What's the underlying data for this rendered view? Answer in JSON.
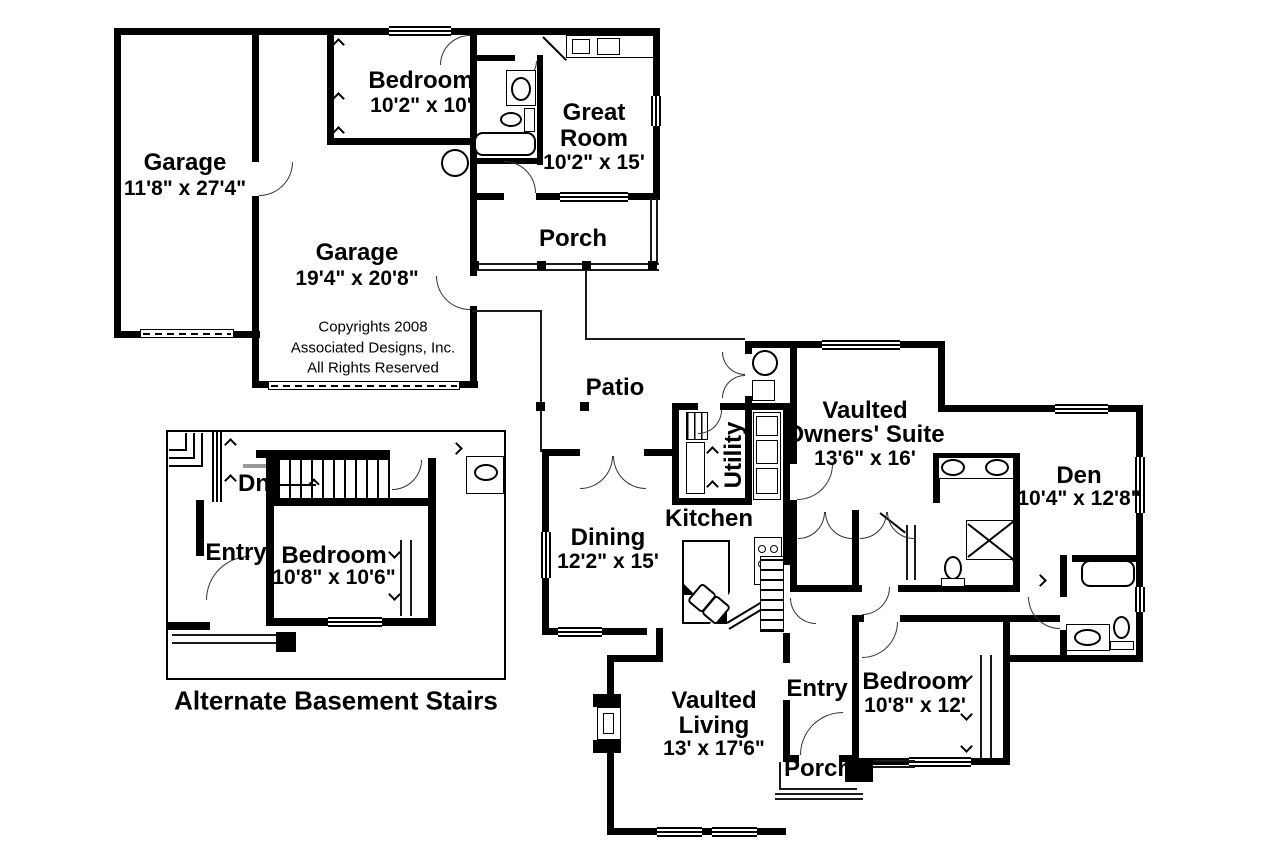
{
  "canvas": {
    "width": 1280,
    "height": 853,
    "background": "#ffffff"
  },
  "colors": {
    "wall": "#000000",
    "thin_line": "#1a1a1a",
    "arc_line": "#333333",
    "text": "#000000"
  },
  "copyright": {
    "line1": "Copyrights 2008",
    "line2": "Associated Designs, Inc.",
    "line3": "All Rights Reserved"
  },
  "rooms": {
    "garage_left": {
      "name": "Garage",
      "dims": "11'8\" x 27'4\""
    },
    "garage_main": {
      "name": "Garage",
      "dims": "19'4\" x 20'8\""
    },
    "bedroom_garage": {
      "name": "Bedroom",
      "dims": "10'2\" x 10'"
    },
    "great_room": {
      "line1": "Great",
      "line2": "Room",
      "dims": "10'2\" x 15'"
    },
    "porch_upper": {
      "name": "Porch"
    },
    "patio": {
      "name": "Patio"
    },
    "dining": {
      "name": "Dining",
      "dims": "12'2\" x 15'"
    },
    "kitchen": {
      "name": "Kitchen"
    },
    "utility": {
      "name": "Utility"
    },
    "owners_suite": {
      "prefix": "Vaulted",
      "name": "Owners' Suite",
      "dims": "13'6\" x 16'"
    },
    "den": {
      "name": "Den",
      "dims": "10'4\" x 12'8\""
    },
    "bedroom_right": {
      "name": "Bedroom",
      "dims": "10'8\" x 12'"
    },
    "entry": {
      "name": "Entry"
    },
    "porch_lower": {
      "name": "Porch"
    },
    "living": {
      "prefix": "Vaulted",
      "name": "Living",
      "dims": "13' x 17'6\""
    }
  },
  "inset": {
    "caption": "Alternate Basement Stairs",
    "entry": {
      "name": "Entry"
    },
    "bedroom": {
      "name": "Bedroom",
      "dims": "10'8\" x 10'6\""
    },
    "stairs_note": "Dn"
  }
}
